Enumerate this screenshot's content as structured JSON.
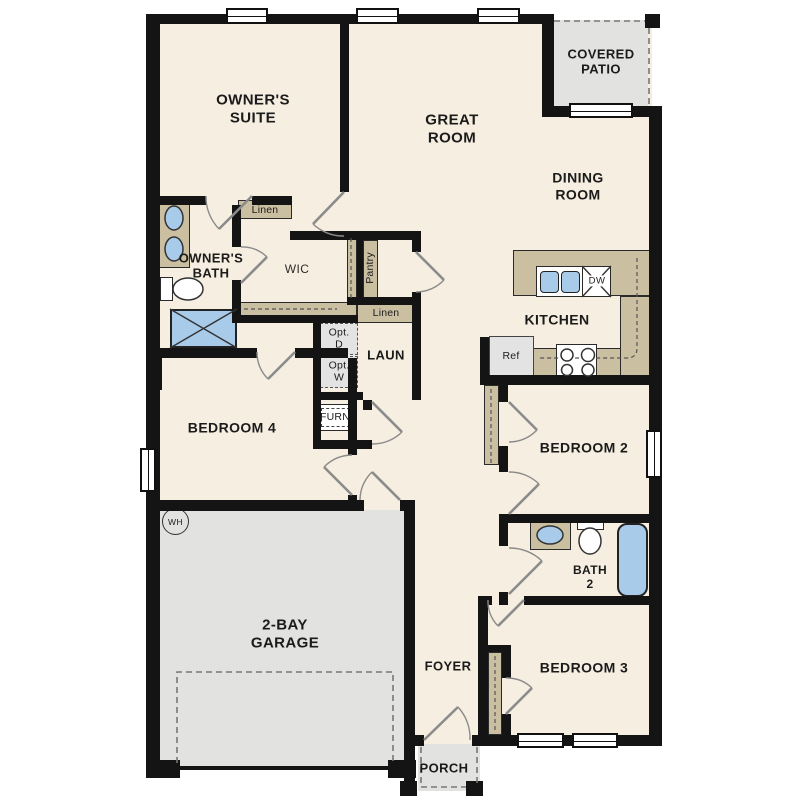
{
  "type": "residential-floor-plan",
  "labels": {
    "owners_suite": "OWNER'S\nSUITE",
    "great_room": "GREAT\nROOM",
    "covered_patio": "COVERED\nPATIO",
    "dining_room": "DINING\nROOM",
    "owners_bath": "OWNER'S\nBATH",
    "wic": "WIC",
    "linen_closet": "Linen",
    "linen_hall": "Linen",
    "pantry": "Pantry",
    "laundry": "LAUN",
    "opt_dryer": "Opt.\nD",
    "opt_washer": "Opt.\nW",
    "furnace": "FURN",
    "kitchen": "KITCHEN",
    "refrigerator": "Ref",
    "dishwasher": "DW",
    "bedroom_4": "BEDROOM 4",
    "bedroom_2": "BEDROOM 2",
    "bedroom_3": "BEDROOM 3",
    "bath_2": "BATH\n2",
    "garage": "2-BAY\nGARAGE",
    "water_heater": "WH",
    "foyer": "FOYER",
    "porch": "PORCH"
  },
  "colors": {
    "floor": "#f6eee0",
    "wall": "#141414",
    "casework": "#cbbfa2",
    "outdoor": "#e2e2e1",
    "fixture_blue": "#a9cbea",
    "appliance": "#e3e3e3",
    "door": "#8b8b8b",
    "text": "#1b1b1b"
  }
}
